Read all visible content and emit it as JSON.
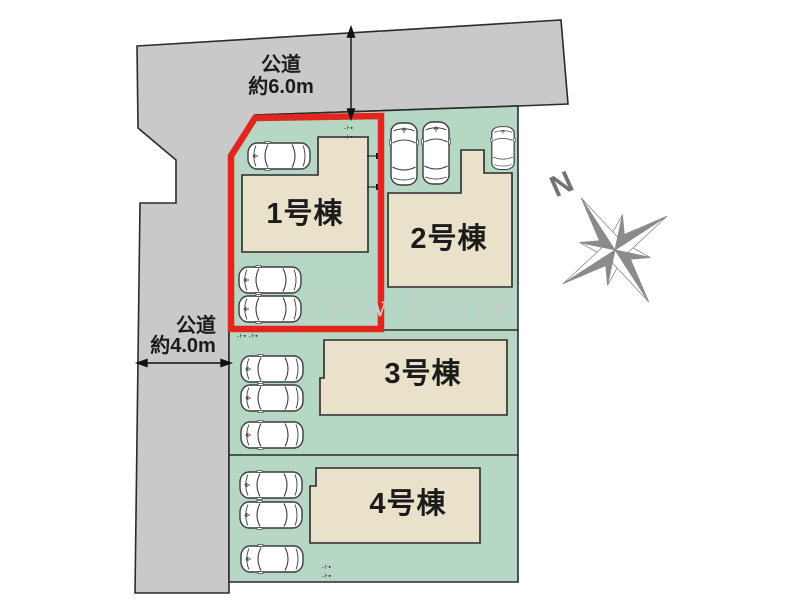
{
  "colors": {
    "bg": "#ffffff",
    "road": "#c9c9cb",
    "site": "#b5d7c4",
    "bld": "#eae1ca",
    "line": "#2b2b2b",
    "car": "#3c3c3c",
    "red": "#e3261d",
    "wm": "#c6cfcc",
    "compass": "#8a8b8d",
    "text": "#1b1b1b"
  },
  "roads": {
    "top": {
      "name_line1": "公道",
      "name_line2": "約6.0m"
    },
    "left": {
      "name_line1": "公道",
      "name_line2": "約4.0m"
    }
  },
  "plots": [
    {
      "label": "1号棟",
      "highlighted": true
    },
    {
      "label": "2号棟",
      "highlighted": false
    },
    {
      "label": "3号棟",
      "highlighted": false
    },
    {
      "label": "4号棟",
      "highlighted": false
    }
  ],
  "compass": {
    "north_label": "N"
  },
  "watermark": {
    "text": "view house"
  },
  "marks": {
    "pair": "-⊦▪",
    "double": "-⊦▪ -⊦▪"
  }
}
